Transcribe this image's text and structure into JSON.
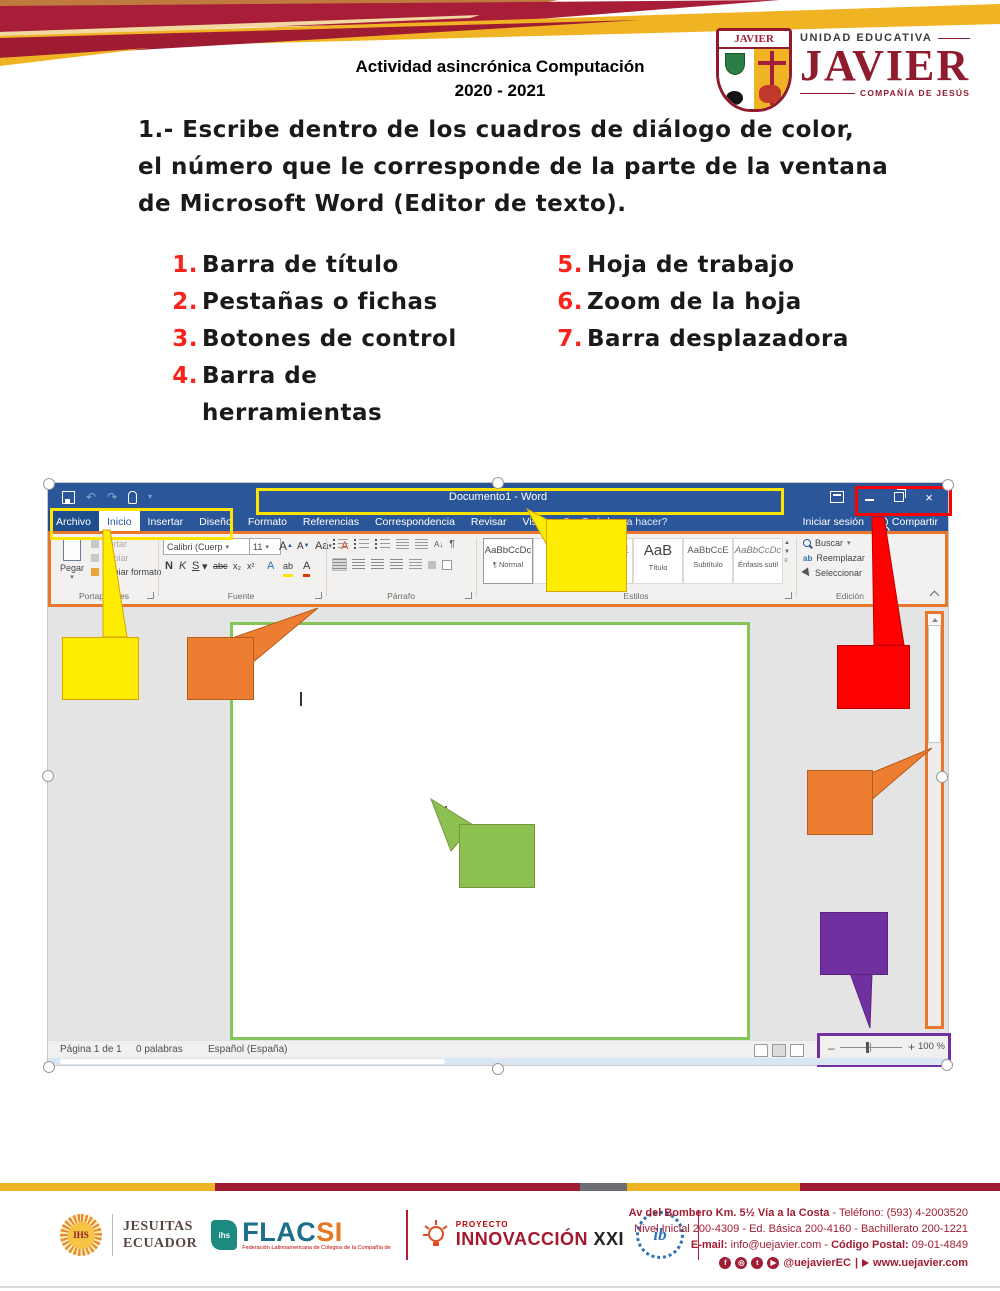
{
  "colors": {
    "word_blue": "#2B579A",
    "callout_yellow": "#FFED00",
    "callout_orange": "#ED7D31",
    "callout_red": "#FF0000",
    "callout_green": "#8CC152",
    "callout_purple": "#7030A0",
    "page_border_green": "#84C45A",
    "ribbon_outline_orange": "#E8762C",
    "header_maroon": "#9E1B32",
    "header_gold": "#F0B323",
    "list_number_red": "#F8241B"
  },
  "icons": {
    "dropdown": "▾",
    "close": "×",
    "undo": "↶",
    "redo": "↷",
    "sort": "A↓",
    "pilcrow": "¶"
  },
  "header": {
    "activity_title": "Actividad asincrónica Computación",
    "school_year": "2020 - 2021",
    "logo": {
      "shield_label": "JAVIER",
      "unit": "UNIDAD EDUCATIVA",
      "name": "JAVIER",
      "company": "COMPAÑÍA DE JESÚS"
    }
  },
  "task": {
    "line1": "1.- Escribe dentro de los cuadros de diálogo de color,",
    "line2": "el número que le corresponde de la parte de la ventana",
    "line3": "de Microsoft Word (Editor de texto)."
  },
  "parts_list": {
    "items": [
      {
        "num": "1.",
        "label": "Barra de título"
      },
      {
        "num": "2.",
        "label": "Pestañas o fichas"
      },
      {
        "num": "3.",
        "label": "Botones de control"
      },
      {
        "num": "4.",
        "label": "Barra de herramientas"
      },
      {
        "num": "5.",
        "label": "Hoja de trabajo"
      },
      {
        "num": "6.",
        "label": "Zoom de la hoja"
      },
      {
        "num": "7.",
        "label": "Barra desplazadora"
      }
    ]
  },
  "word": {
    "titlebar": {
      "document_title": "Documento1 - Word"
    },
    "tabs": [
      "Archivo",
      "Inicio",
      "Insertar",
      "Diseño",
      "Formato",
      "Referencias",
      "Correspondencia",
      "Revisar",
      "Vista"
    ],
    "tellme": "¿Qué desea hacer?",
    "account": {
      "sign_in": "Iniciar sesión",
      "share": "Compartir"
    },
    "ribbon": {
      "clipboard": {
        "paste": "Pegar",
        "cut": "Cortar",
        "copy": "Copiar",
        "painter": "Copiar formato",
        "label": "Portapapeles"
      },
      "font": {
        "name": "Calibri (Cuerp",
        "size": "11",
        "grow": "A",
        "shrink": "A",
        "case": "Aa",
        "bold": "N",
        "italic": "K",
        "underline": "S",
        "strike": "abc",
        "subscript": "x₂",
        "superscript": "x²",
        "effects": "A",
        "highlight": "ab",
        "color": "A",
        "label": "Fuente"
      },
      "paragraph": {
        "label": "Párrafo"
      },
      "styles": {
        "label": "Estilos",
        "items": [
          {
            "sample": "AaBbCcDc",
            "name": "¶ Normal"
          },
          {
            "sample": "AaBb",
            "name": "¶ Sin e"
          },
          {
            "sample": "AaBbCcE",
            "name": "Título 2"
          },
          {
            "sample": "AaB",
            "name": "Título"
          },
          {
            "sample": "AaBbCcE",
            "name": "Subtítulo"
          },
          {
            "sample": "AaBbCcDc",
            "name": "Énfasis sutil"
          }
        ]
      },
      "editing": {
        "find": "Buscar",
        "replace": "Reemplazar",
        "select": "Seleccionar",
        "label": "Edición"
      }
    },
    "status": {
      "page": "Página 1 de 1",
      "words": "0 palabras",
      "language": "Español (España)",
      "minus": "–",
      "plus": "+",
      "zoom": "100 %"
    }
  },
  "footer": {
    "jesuitas": {
      "emblem": "IHS",
      "line1": "JESUITAS",
      "line2": "ECUADOR"
    },
    "flacsi": {
      "ihs": "ihs",
      "name_main": "FLAC",
      "name_accent": "SI",
      "tagline": "Federación Latinoamericana de Colegios de la Compañía de Jesús"
    },
    "proyecto": {
      "small": "PROYECTO",
      "name": "INNOVACCIÓN",
      "suffix": " XXI"
    },
    "ib": {
      "label": "ib"
    },
    "contact": {
      "address_bold": "Av del Bombero Km. 5½ Vía a la Costa",
      "address_rest": " - Teléfono: (593) 4-2003520",
      "levels": "Nivel Inicial 200-4309 - Ed. Básica 200-4160 - Bachillerato 200-1221",
      "email_label": "E-mail:",
      "email_value": " info@uejavier.com - ",
      "postal_label": "Código Postal:",
      "postal_value": " 09-01-4849",
      "social": {
        "facebook": "f",
        "instagram": "◎",
        "twitter": "t",
        "youtube": "▶"
      },
      "handle": "@uejavierEC",
      "separator": "|",
      "website": "www.uejavier.com"
    }
  }
}
